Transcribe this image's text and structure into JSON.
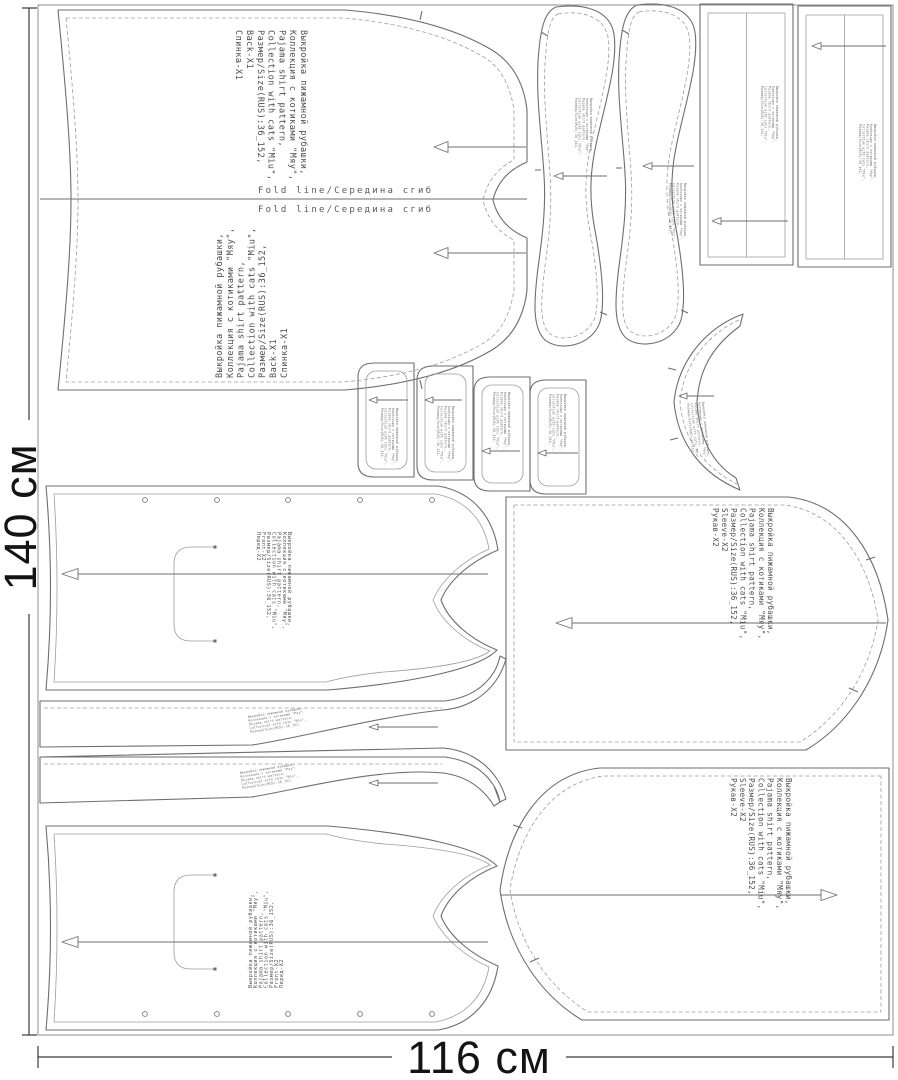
{
  "sheet": {
    "height_label": "140 см",
    "width_label": "116 см"
  },
  "fold": {
    "label": "Fold line/Середина сгиб"
  },
  "info": {
    "line1": "Выкройка пижамной рубашки,",
    "line2": "Коллекция с котиками \"Мяу\",",
    "line3": "Pajama shirt pattern,",
    "line4": "Collection with cats \"Miu\",",
    "line5": "Размер/Size(RUS):36_152,"
  },
  "pieces": {
    "back": {
      "label_en": "Back-X1",
      "label_ru": "Спинка-X1"
    },
    "front": {
      "label_en": "Front-X2",
      "label_ru": "Перед-X2"
    },
    "sleeve": {
      "label_en": "Sleeve-X2",
      "label_ru": "Рукав-X2"
    }
  }
}
